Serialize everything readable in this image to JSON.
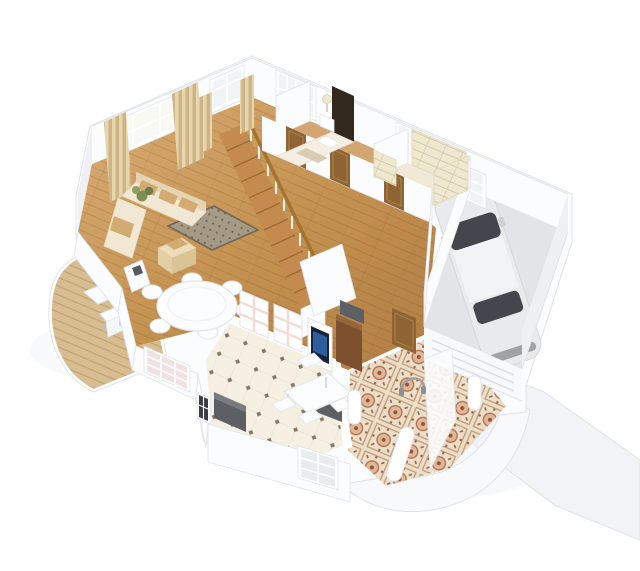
{
  "scene": {
    "type": "isometric-3d-floor-plan-render",
    "view": "cutaway dollhouse from above",
    "background": "#ffffff",
    "rooms": [
      {
        "name": "living-room",
        "floor": "hardwood",
        "items": [
          "corner-sofa",
          "patterned-area-rug",
          "ottoman-with-cushions",
          "striped-curtains",
          "sheer-window",
          "plant",
          "media-cabinet"
        ]
      },
      {
        "name": "dining-area",
        "floor": "hardwood",
        "items": [
          "round-white-table",
          "six-white-chairs"
        ]
      },
      {
        "name": "hallway",
        "floor": "hardwood",
        "items": [
          "wooden-staircase",
          "white-balustrade",
          "three-wood-doors"
        ]
      },
      {
        "name": "bedroom",
        "floor": "hardwood",
        "items": [
          "double-bed",
          "dark-headboard",
          "pillows",
          "nightstand",
          "table-lamp"
        ]
      },
      {
        "name": "walk-in-closet",
        "floor": "cream",
        "items": [
          "cream-shelving-units"
        ]
      },
      {
        "name": "garage",
        "floor": "concrete",
        "items": [
          "white-car",
          "garage-door",
          "small-window"
        ]
      },
      {
        "name": "kitchen",
        "floor": "diamond-accent-tile",
        "items": [
          "wall-shelf-units",
          "tv-panel",
          "white-table",
          "four-chairs",
          "dark-counters",
          "tall-brown-cabinet"
        ]
      },
      {
        "name": "foyer",
        "floor": "ornamental-mosaic-tile",
        "items": [
          "white-bench",
          "door-ornament",
          "front-door",
          "shoe-cabinet"
        ]
      },
      {
        "name": "deck",
        "floor": "wood-planks",
        "items": [
          "white-table",
          "two-white-chairs"
        ]
      },
      {
        "name": "exterior",
        "items": [
          "concrete-driveway",
          "rounded-porch",
          "porch-pillars"
        ]
      }
    ]
  },
  "palette": {
    "background": "#ffffff",
    "wall": "#fbfcfd",
    "wall_shade": "#eef0f4",
    "wall_edge": "#dfe3e8",
    "glass": "#f1f4f6",
    "wood_hi": "#d9ad76",
    "wood_mid": "#c3914f",
    "wood_lo": "#b07c45",
    "wood_line": "#8a5a28",
    "bedroom_floor": "#d2a571",
    "deck": "#d9bd92",
    "deck_line": "#c2a26f",
    "tile_kitchen": "#f6f0e3",
    "tile_kitchen_dot": "#847663",
    "tile_grout": "#e7dfcf",
    "tile_foyer": "#ecdfc9",
    "tile_foyer_line": "#c19a73",
    "tile_foyer_rose": "#b5714f",
    "tile_foyer_center": "#a0522d",
    "sofa": "#f1e8d3",
    "sofa_shade": "#e4d4b3",
    "cushion": "#d3ab72",
    "rug": "#a49a85",
    "rug_dark": "#6f6757",
    "curtain_a": "#e7d6ac",
    "curtain_b": "#cdb488",
    "door": "#8f6434",
    "door_panel": "#a97f47",
    "headboard": "#33281e",
    "bedding": "#f4efe2",
    "closet": "#efe8d0",
    "closet_line": "#d6cba6",
    "garage_floor": "#e2e4e7",
    "car_body": "#e9eaec",
    "car_roof": "#f2f3f5",
    "car_glass": "#43464c",
    "car_trim": "#9fa3a9",
    "counter_dark": "#5c6065",
    "counter_top": "#787c81",
    "cabinet": "#7c502e",
    "cabinet_top": "#95653c",
    "tv_screen": "#16233a",
    "tv_image": "#2f5e9e",
    "driveway": "#f2f3f6",
    "porch": "#f8f9fb",
    "shadow": "#e9ecf0",
    "plant": "#7f9054",
    "white_furniture": "#fcfdfe",
    "furniture_edge": "#e2e5ea",
    "stair_wood": "#c48a4e",
    "stair_line": "#9a6a38",
    "handrail": "#a5742e"
  }
}
